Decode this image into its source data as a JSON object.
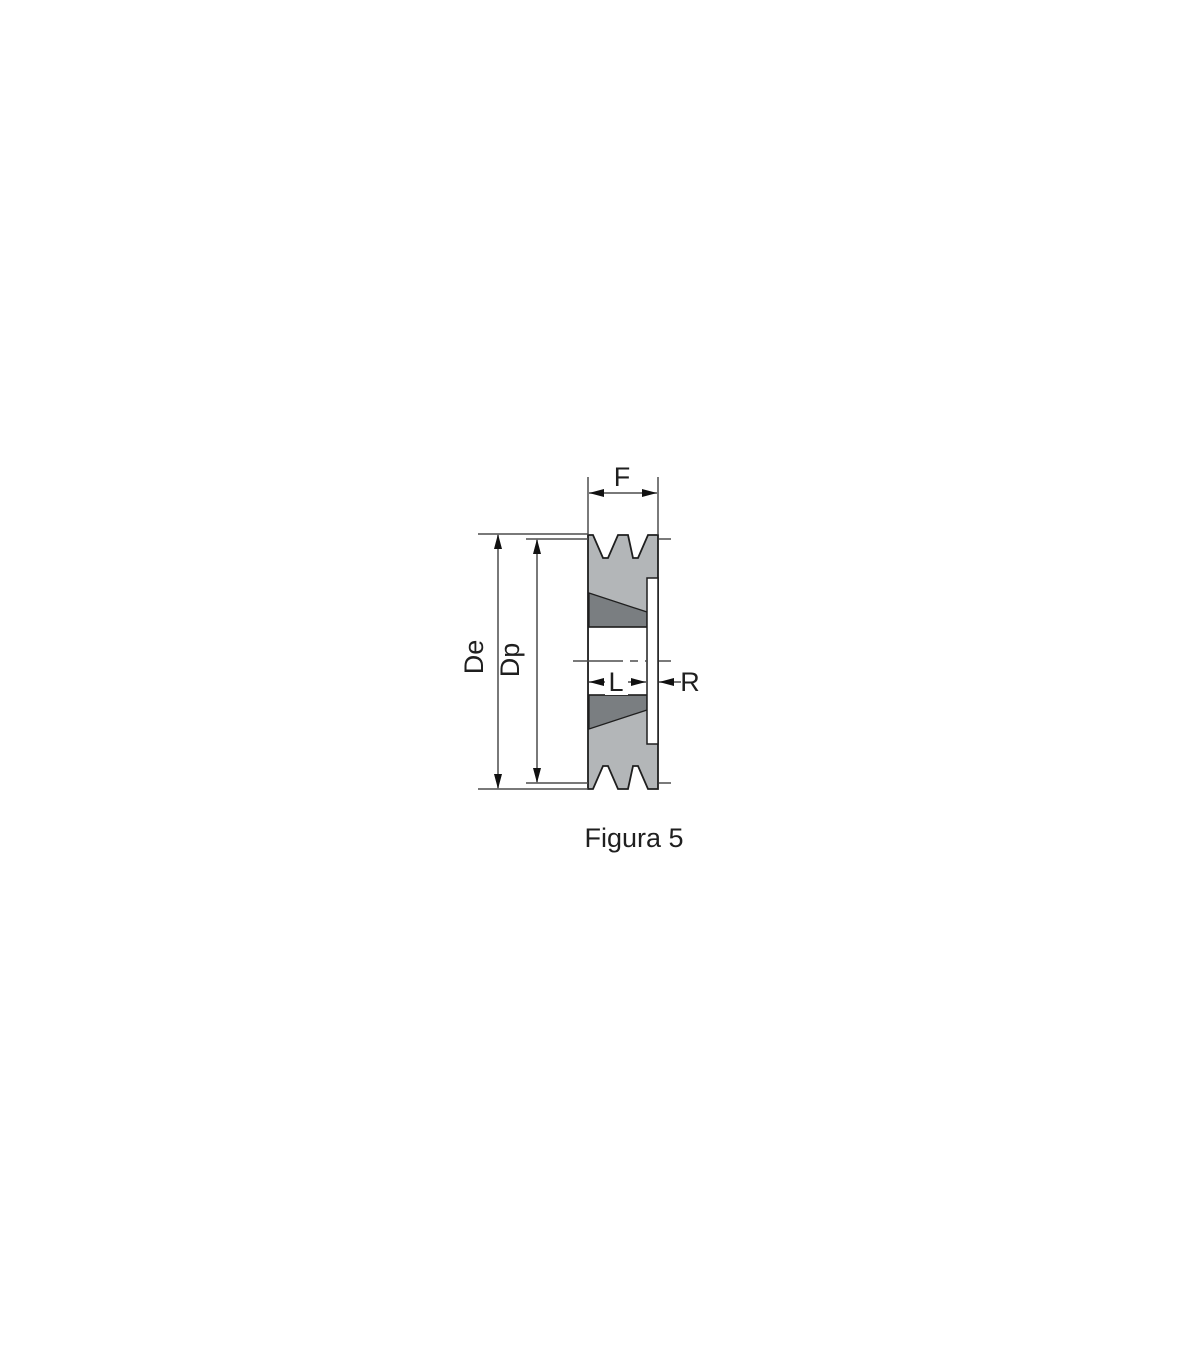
{
  "figure": {
    "caption": "Figura 5",
    "labels": {
      "face_width": "F",
      "outer_diameter": "De",
      "pitch_diameter": "Dp",
      "hub_length": "L",
      "rim_width": "R"
    },
    "colors": {
      "background": "#ffffff",
      "pulley_body": "#b3b6b8",
      "taper_bushing": "#7a7e81",
      "outline": "#1f1f1f",
      "dimension_line": "#4d4d4d",
      "arrow": "#111111",
      "text": "#1f1f1f"
    }
  }
}
